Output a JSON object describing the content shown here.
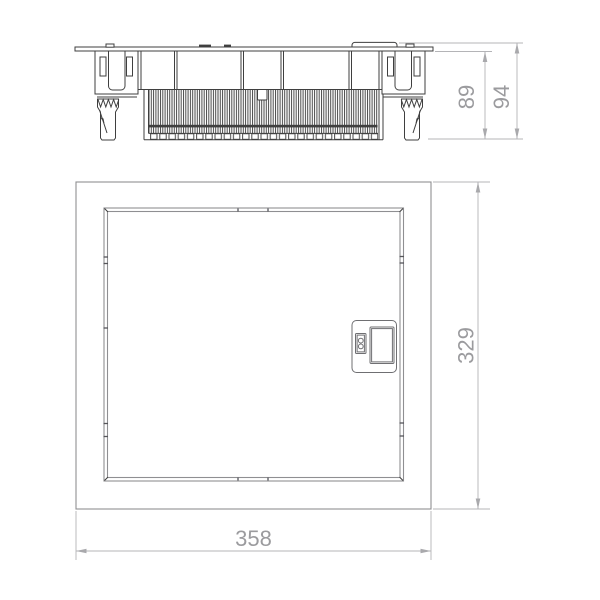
{
  "drawing": {
    "colors": {
      "background": "#ffffff",
      "part_line": "#3f3f3f",
      "front_view_line": "#8f8f92",
      "dimension_line": "#b4b4b7",
      "dimension_text": "#9b9b9e"
    },
    "side_view": {
      "dim_inner_height": "89",
      "dim_total_height": "94"
    },
    "front_view": {
      "dim_height": "329",
      "dim_width": "358"
    }
  }
}
